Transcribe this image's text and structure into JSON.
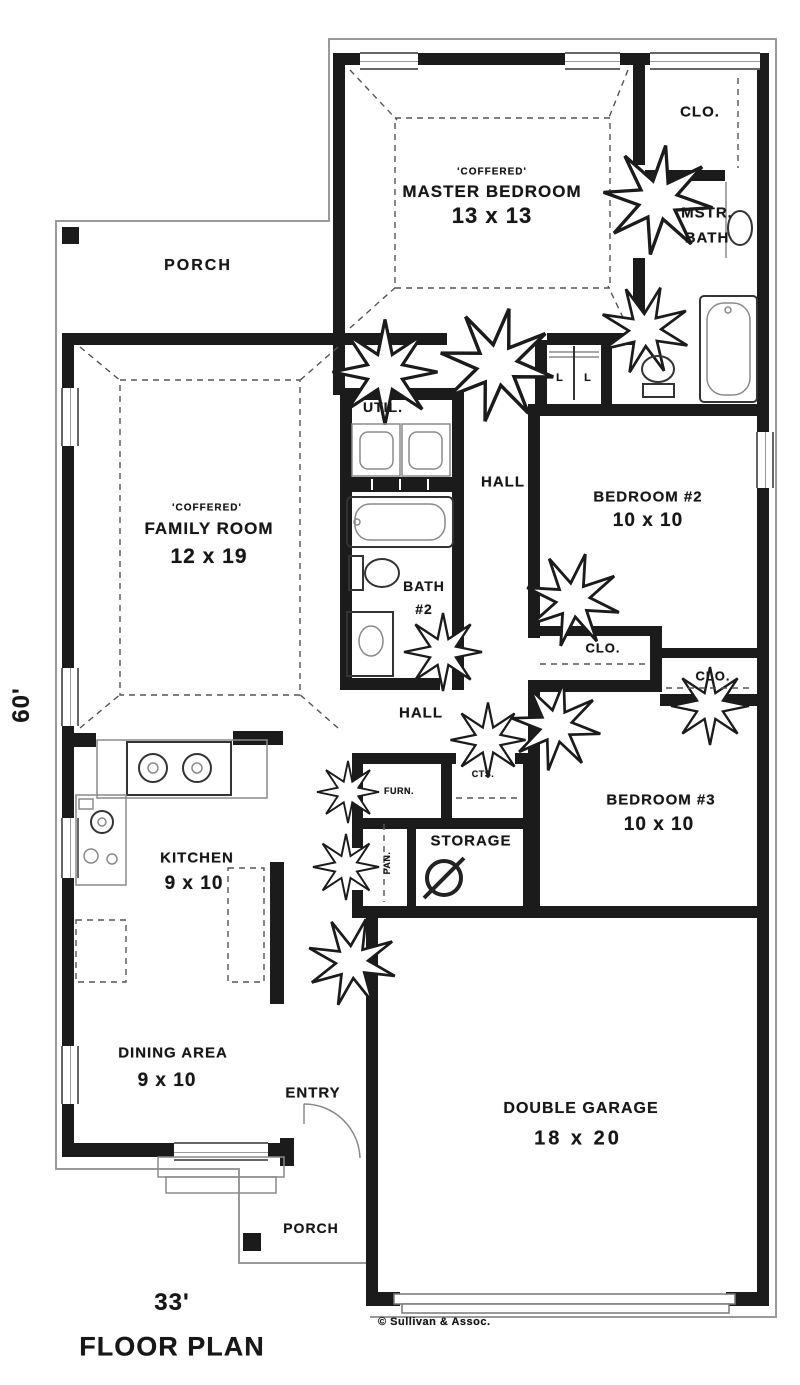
{
  "meta": {
    "plan_title": "FLOOR PLAN",
    "width_dim": "33'",
    "height_dim": "60'",
    "credit": "© Sullivan & Assoc."
  },
  "rooms": {
    "porch_top": {
      "label": "PORCH"
    },
    "master_bedroom": {
      "ceiling": "'COFFERED'",
      "label": "MASTER BEDROOM",
      "dims": "13 x 13"
    },
    "master_closet": {
      "label": "CLO."
    },
    "master_bath": {
      "label_line1": "MSTR.",
      "label_line2": "BATH"
    },
    "utility": {
      "label": "UTIL."
    },
    "hall_upper": {
      "label": "HALL"
    },
    "family_room": {
      "ceiling": "'COFFERED'",
      "label": "FAMILY ROOM",
      "dims": "12 x 19"
    },
    "bedroom_2": {
      "label": "BEDROOM #2",
      "dims": "10 x 10"
    },
    "bath_2": {
      "label_line1": "BATH",
      "label_line2": "#2"
    },
    "closet_2": {
      "label": "CLO."
    },
    "closet_3": {
      "label": "CLO."
    },
    "hall_lower": {
      "label": "HALL"
    },
    "furnace": {
      "label": "FURN."
    },
    "coats": {
      "label": "CTS."
    },
    "storage": {
      "label": "STORAGE"
    },
    "pantry": {
      "label": "PAN."
    },
    "kitchen": {
      "label": "KITCHEN",
      "dims": "9 x 10"
    },
    "bedroom_3": {
      "label": "BEDROOM #3",
      "dims": "10 x 10"
    },
    "dining_area": {
      "label": "DINING AREA",
      "dims": "9 x 10"
    },
    "entry": {
      "label": "ENTRY"
    },
    "garage": {
      "label": "DOUBLE GARAGE",
      "dims": "18 x 20"
    },
    "porch_bottom": {
      "label": "PORCH"
    },
    "linen_1": {
      "label": "L"
    },
    "linen_2": {
      "label": "L"
    }
  }
}
